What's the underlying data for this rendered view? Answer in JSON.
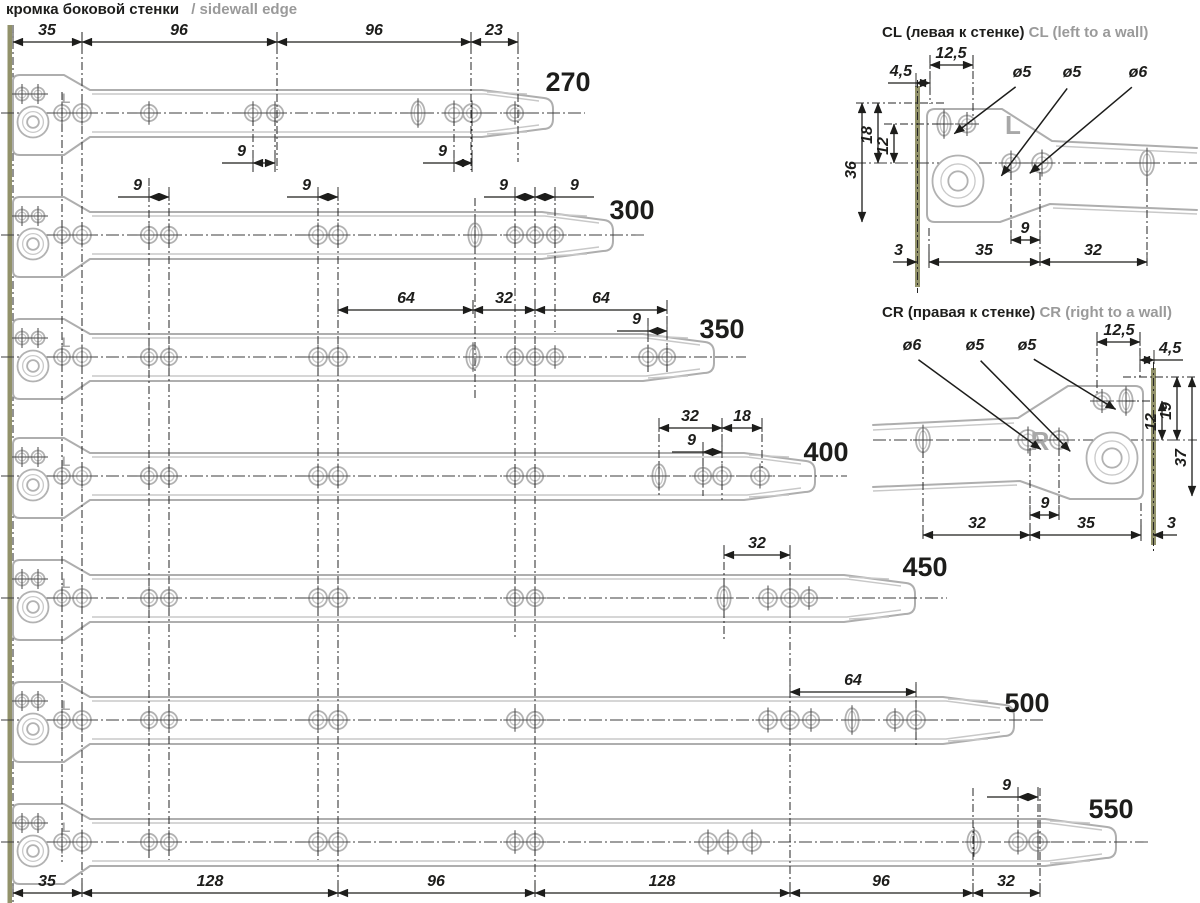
{
  "title": {
    "ru": "кромка боковой стенки",
    "en": "/ sidewall edge"
  },
  "colors": {
    "ink": "#1d1d1b",
    "gray_text": "#9a9a9a",
    "rail": "#aeaeae",
    "wall_edge": "#92926a"
  },
  "chart_data": {
    "type": "table",
    "title": "Roller drawer slide lengths and hole patterns (mm)",
    "lengths_mm": [
      270,
      300,
      350,
      400,
      450,
      500,
      550
    ],
    "top_dims_mm": [
      35,
      96,
      96,
      23
    ],
    "bottom_dims_mm": [
      35,
      128,
      96,
      128,
      96,
      32
    ],
    "hole_pair_pitch_mm": 9,
    "other_dims_mm": [
      64,
      32,
      18
    ],
    "hole_diameters_mm": [
      5,
      5,
      6
    ],
    "wall_offset_mm": 3,
    "bracket_dims_mm": {
      "cl": [
        4.5,
        12.5,
        36,
        18,
        12,
        3,
        35,
        9,
        32
      ],
      "cr": [
        12.5,
        4.5,
        12,
        19,
        37,
        32,
        9,
        35,
        3
      ]
    }
  },
  "drawing": {
    "top_dims": {
      "y": 42,
      "ly": 35,
      "items": [
        {
          "t": "35",
          "x1": 13,
          "x2": 82,
          "lx": 47
        },
        {
          "t": "96",
          "x1": 82,
          "x2": 277,
          "lx": 179
        },
        {
          "t": "96",
          "x1": 277,
          "x2": 471,
          "lx": 374
        },
        {
          "t": "23",
          "x1": 471,
          "x2": 518,
          "lx": 494
        }
      ]
    },
    "bottom_dims": {
      "y": 893,
      "ly": 886,
      "items": [
        {
          "t": "35",
          "x1": 13,
          "x2": 82,
          "lx": 47
        },
        {
          "t": "128",
          "x1": 82,
          "x2": 338,
          "lx": 210
        },
        {
          "t": "96",
          "x1": 338,
          "x2": 535,
          "lx": 436
        },
        {
          "t": "128",
          "x1": 535,
          "x2": 790,
          "lx": 662
        },
        {
          "t": "96",
          "x1": 790,
          "x2": 973,
          "lx": 881
        },
        {
          "t": "32",
          "x1": 973,
          "x2": 1040,
          "lx": 1006
        }
      ]
    },
    "rails": [
      {
        "label": "270",
        "c": 113,
        "tip": 557,
        "has_l": true,
        "lp": [
          568,
          91
        ],
        "holes": [
          149,
          253,
          275,
          454,
          472,
          515
        ],
        "slots": [
          418
        ],
        "dims": [
          {
            "t": "9",
            "x1": 253,
            "x2": 275,
            "y": 163,
            "lx": 246,
            "ly": 156,
            "la": "end"
          },
          {
            "t": "9",
            "x1": 454,
            "x2": 472,
            "y": 163,
            "lx": 447,
            "ly": 156,
            "la": "end"
          }
        ]
      },
      {
        "label": "300",
        "c": 235,
        "tip": 617,
        "has_l": false,
        "lp": [
          632,
          219
        ],
        "holes": [
          149,
          169,
          318,
          338,
          515,
          535,
          555
        ],
        "slots": [
          475
        ],
        "dims": [
          {
            "t": "9",
            "x1": 149,
            "x2": 169,
            "y": 197,
            "lx": 142,
            "ly": 190,
            "la": "end"
          },
          {
            "t": "9",
            "x1": 318,
            "x2": 338,
            "y": 197,
            "lx": 311,
            "ly": 190,
            "la": "end"
          },
          {
            "t": "9",
            "x1": 515,
            "x2": 535,
            "y": 197,
            "lx": 508,
            "ly": 190,
            "la": "end"
          },
          {
            "t": "9",
            "x1": 535,
            "x2": 555,
            "y": 197,
            "lx": 570,
            "ly": 190,
            "la": "start"
          }
        ]
      },
      {
        "label": "350",
        "c": 357,
        "tip": 718,
        "has_l": true,
        "lp": [
          722,
          338
        ],
        "holes": [
          149,
          169,
          318,
          338,
          515,
          535,
          555,
          648,
          667
        ],
        "slots": [
          473
        ],
        "dims": [
          {
            "t": "64",
            "x1": 338,
            "x2": 473,
            "y": 310,
            "lx": 406,
            "ly": 303,
            "la": "middle"
          },
          {
            "t": "32",
            "x1": 473,
            "x2": 535,
            "y": 310,
            "lx": 504,
            "ly": 303,
            "la": "middle"
          },
          {
            "t": "64",
            "x1": 535,
            "x2": 667,
            "y": 310,
            "lx": 601,
            "ly": 303,
            "la": "middle"
          },
          {
            "t": "9",
            "x1": 648,
            "x2": 667,
            "y": 331,
            "lx": 641,
            "ly": 324,
            "la": "end"
          }
        ]
      },
      {
        "label": "400",
        "c": 476,
        "tip": 819,
        "has_l": true,
        "lp": [
          826,
          461
        ],
        "holes": [
          149,
          169,
          318,
          338,
          515,
          535,
          703,
          722,
          760
        ],
        "slots": [
          659
        ],
        "dims": [
          {
            "t": "32",
            "x1": 659,
            "x2": 722,
            "y": 428,
            "lx": 690,
            "ly": 421,
            "la": "middle"
          },
          {
            "t": "18",
            "x1": 722,
            "x2": 762,
            "y": 428,
            "lx": 742,
            "ly": 421,
            "la": "middle"
          },
          {
            "t": "9",
            "x1": 703,
            "x2": 722,
            "y": 452,
            "lx": 696,
            "ly": 445,
            "la": "end"
          }
        ]
      },
      {
        "label": "450",
        "c": 598,
        "tip": 919,
        "has_l": true,
        "lp": [
          925,
          576
        ],
        "holes": [
          149,
          169,
          318,
          338,
          515,
          535,
          768,
          790,
          809
        ],
        "slots": [
          724
        ],
        "dims": [
          {
            "t": "32",
            "x1": 724,
            "x2": 790,
            "y": 555,
            "lx": 757,
            "ly": 548,
            "la": "middle"
          }
        ]
      },
      {
        "label": "500",
        "c": 720,
        "tip": 1018,
        "has_l": true,
        "lp": [
          1027,
          712
        ],
        "holes": [
          149,
          169,
          318,
          338,
          515,
          535,
          768,
          790,
          811,
          895,
          916
        ],
        "slots": [
          852
        ],
        "dims": [
          {
            "t": "64",
            "x1": 790,
            "x2": 916,
            "y": 692,
            "lx": 853,
            "ly": 685,
            "la": "middle"
          }
        ]
      },
      {
        "label": "550",
        "c": 842,
        "tip": 1120,
        "has_l": true,
        "lp": [
          1111,
          818
        ],
        "holes": [
          149,
          169,
          318,
          338,
          515,
          535,
          708,
          728,
          752,
          1018,
          1038
        ],
        "slots": [
          974
        ],
        "dims": [
          {
            "t": "9",
            "x1": 1018,
            "x2": 1038,
            "y": 797,
            "lx": 1011,
            "ly": 790,
            "la": "end"
          }
        ]
      }
    ],
    "columns": [
      {
        "x": 62,
        "y1": 92,
        "y2": 862
      },
      {
        "x": 82,
        "y1": 46,
        "y2": 893
      },
      {
        "x": 149,
        "y1": 178,
        "y2": 860
      },
      {
        "x": 169,
        "y1": 192,
        "y2": 860
      },
      {
        "x": 277,
        "y1": 46,
        "y2": 170
      },
      {
        "x": 318,
        "y1": 192,
        "y2": 860
      },
      {
        "x": 338,
        "y1": 192,
        "y2": 893
      },
      {
        "x": 471,
        "y1": 46,
        "y2": 170
      },
      {
        "x": 518,
        "y1": 46,
        "y2": 162
      },
      {
        "x": 475,
        "y1": 198,
        "y2": 398
      },
      {
        "x": 515,
        "y1": 192,
        "y2": 640
      },
      {
        "x": 535,
        "y1": 192,
        "y2": 893
      },
      {
        "x": 555,
        "y1": 192,
        "y2": 332
      },
      {
        "x": 253,
        "y1": 118,
        "y2": 172
      },
      {
        "x": 275,
        "y1": 118,
        "y2": 172
      },
      {
        "x": 454,
        "y1": 118,
        "y2": 172
      },
      {
        "x": 472,
        "y1": 118,
        "y2": 172
      },
      {
        "x": 648,
        "y1": 318,
        "y2": 372
      },
      {
        "x": 667,
        "y1": 300,
        "y2": 372
      },
      {
        "x": 659,
        "y1": 418,
        "y2": 498
      },
      {
        "x": 703,
        "y1": 442,
        "y2": 496
      },
      {
        "x": 722,
        "y1": 418,
        "y2": 500
      },
      {
        "x": 762,
        "y1": 418,
        "y2": 468
      },
      {
        "x": 724,
        "y1": 546,
        "y2": 640
      },
      {
        "x": 790,
        "y1": 546,
        "y2": 893
      },
      {
        "x": 916,
        "y1": 684,
        "y2": 748
      },
      {
        "x": 973,
        "y1": 788,
        "y2": 893
      },
      {
        "x": 1040,
        "y1": 788,
        "y2": 893
      },
      {
        "x": 1018,
        "y1": 788,
        "y2": 838
      },
      {
        "x": 1038,
        "y1": 788,
        "y2": 866
      }
    ]
  },
  "details": {
    "cl": {
      "title_ru": "CL (левая к стенке)",
      "title_en": "CL (left to a wall)",
      "mark": "L",
      "title_pos": [
        882,
        37
      ],
      "hdims": [
        {
          "t": "12,5",
          "x1": 930,
          "x2": 973,
          "y": 65,
          "lx": 951,
          "ly": 58,
          "la": "middle"
        },
        {
          "t": "4,5",
          "x1": 916,
          "x2": 930,
          "y": 83,
          "lx": 912,
          "ly": 76,
          "la": "end"
        }
      ],
      "callouts": [
        {
          "t": "ø5",
          "x": 1022,
          "y": 77,
          "hx": 967,
          "hy": 124
        },
        {
          "t": "ø5",
          "x": 1072,
          "y": 77,
          "hx": 1011,
          "hy": 163
        },
        {
          "t": "ø6",
          "x": 1138,
          "y": 77,
          "hx": 1042,
          "hy": 163
        }
      ],
      "vdims": [
        {
          "t": "36",
          "x": 862,
          "y1": 103,
          "y2": 222,
          "lx": 856,
          "ly": 170
        },
        {
          "t": "18",
          "x": 878,
          "y1": 103,
          "y2": 163,
          "lx": 872,
          "ly": 135
        },
        {
          "t": "12",
          "x": 894,
          "y1": 124,
          "y2": 163,
          "lx": 888,
          "ly": 146
        }
      ],
      "bdims": [
        {
          "t": "35",
          "x1": 929,
          "x2": 1040,
          "y": 262,
          "lx": 984,
          "ly": 255,
          "la": "middle"
        },
        {
          "t": "9",
          "x1": 1011,
          "x2": 1040,
          "y": 240,
          "lx": 1025,
          "ly": 233,
          "la": "middle"
        },
        {
          "t": "32",
          "x1": 1040,
          "x2": 1147,
          "y": 262,
          "lx": 1093,
          "ly": 255,
          "la": "middle"
        }
      ],
      "d3": {
        "t": "3",
        "tip": 917,
        "from": 893,
        "y": 262,
        "lx": 903,
        "ly": 255,
        "la": "end",
        "tick": 929
      }
    },
    "cr": {
      "title_ru": "CR (правая к стенке)",
      "title_en": "CR (right to a wall)",
      "mark": "R",
      "title_pos": [
        882,
        317
      ],
      "hdims": [
        {
          "t": "12,5",
          "x1": 1097,
          "x2": 1140,
          "y": 342,
          "lx": 1119,
          "ly": 335,
          "la": "middle"
        },
        {
          "t": "4,5",
          "x1": 1140,
          "x2": 1154,
          "y": 360,
          "lx": 1159,
          "ly": 353,
          "la": "start"
        }
      ],
      "callouts": [
        {
          "t": "ø6",
          "x": 912,
          "y": 350,
          "hx": 1028,
          "hy": 440
        },
        {
          "t": "ø5",
          "x": 975,
          "y": 350,
          "hx": 1059,
          "hy": 440
        },
        {
          "t": "ø5",
          "x": 1027,
          "y": 350,
          "hx": 1102,
          "hy": 401
        }
      ],
      "vdims": [
        {
          "t": "12",
          "x": 1162,
          "y1": 401,
          "y2": 440,
          "lx": 1156,
          "ly": 422
        },
        {
          "t": "19",
          "x": 1177,
          "y1": 377,
          "y2": 440,
          "lx": 1171,
          "ly": 411
        },
        {
          "t": "37",
          "x": 1192,
          "y1": 377,
          "y2": 496,
          "lx": 1186,
          "ly": 458
        }
      ],
      "bdims": [
        {
          "t": "32",
          "x1": 923,
          "x2": 1030,
          "y": 535,
          "lx": 977,
          "ly": 528,
          "la": "middle"
        },
        {
          "t": "9",
          "x1": 1030,
          "x2": 1059,
          "y": 515,
          "lx": 1045,
          "ly": 508,
          "la": "middle"
        },
        {
          "t": "35",
          "x1": 1030,
          "x2": 1141,
          "y": 535,
          "lx": 1086,
          "ly": 528,
          "la": "middle"
        }
      ],
      "d3": {
        "t": "3",
        "tip": 1153,
        "from": 1177,
        "y": 535,
        "lx": 1167,
        "ly": 528,
        "la": "start",
        "tick": 1141
      }
    }
  }
}
